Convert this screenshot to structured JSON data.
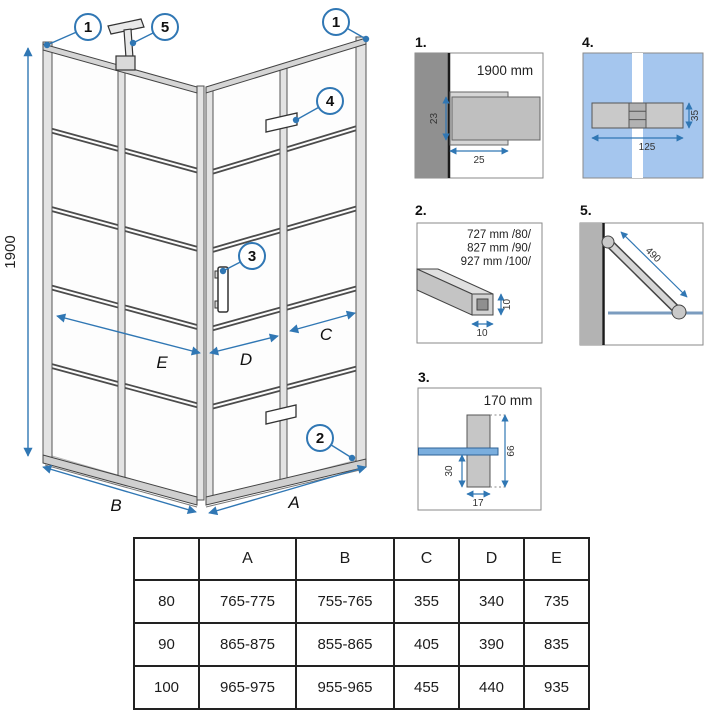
{
  "colors": {
    "accent": "#3077b4",
    "line_dark": "#444444",
    "profile_fill": "#dcdcdc",
    "wall_gray": "#9a9a9a",
    "detail_glass_blue": "#a5c6ee",
    "glass_strip_blue": "#7aaede"
  },
  "drawing": {
    "height_label": "1900",
    "callout_1_left": "1",
    "callout_5": "5",
    "callout_1_right": "1",
    "callout_4": "4",
    "callout_3": "3",
    "callout_2": "2",
    "dim_e": "E",
    "dim_d": "D",
    "dim_c": "C",
    "dim_b": "B",
    "dim_a": "A"
  },
  "details": {
    "d1": {
      "label": "1.",
      "title": "1900 mm",
      "dim_depth": "23",
      "dim_width": "25"
    },
    "d4": {
      "label": "4.",
      "dim_height": "35",
      "dim_length": "125"
    },
    "d2": {
      "label": "2.",
      "sizes": [
        "727 mm /80/",
        "827 mm /90/",
        "927 mm /100/"
      ],
      "dim_v": "10",
      "dim_h": "10"
    },
    "d5": {
      "label": "5.",
      "dim_length": "490"
    },
    "d3": {
      "label": "3.",
      "title": "170 mm",
      "dim_total": "66",
      "dim_below": "30",
      "dim_width": "17"
    }
  },
  "table": {
    "headers": [
      "",
      "A",
      "B",
      "C",
      "D",
      "E"
    ],
    "rows": [
      {
        "size": "80",
        "a": "765-775",
        "b": "755-765",
        "c": "355",
        "d": "340",
        "e": "735"
      },
      {
        "size": "90",
        "a": "865-875",
        "b": "855-865",
        "c": "405",
        "d": "390",
        "e": "835"
      },
      {
        "size": "100",
        "a": "965-975",
        "b": "955-965",
        "c": "455",
        "d": "440",
        "e": "935"
      }
    ]
  }
}
